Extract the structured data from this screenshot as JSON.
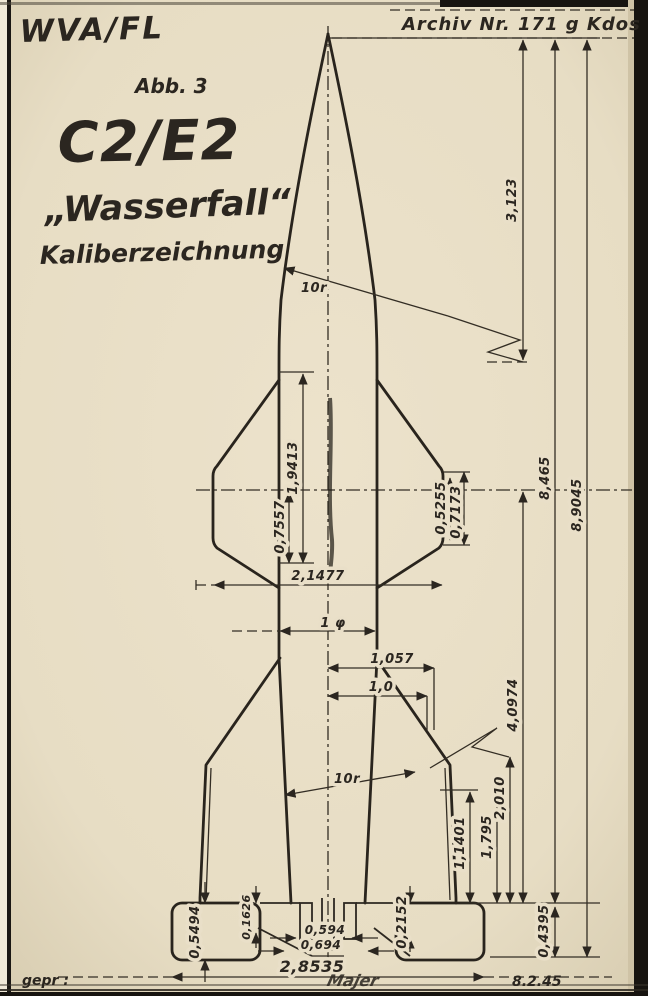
{
  "colors": {
    "paper": "#e8dec6",
    "ink": "#2b2620",
    "frame": "#16130e"
  },
  "header": {
    "org": "WVA/FL",
    "figure_no": "Abb. 3",
    "type_designation": "C2/E2",
    "project_name": "„Wasserfall“",
    "drawing_title": "Kaliberzeichnung",
    "archive_no": "Archiv Nr. 171 g Kdos"
  },
  "dims": {
    "d3123": "3,123",
    "d8465": "8,465",
    "d89045": "8,9045",
    "d19413": "1,9413",
    "d07557": "0,7557",
    "d21477": "2,1477",
    "d05255": "0,5255",
    "d07173": "0,7173",
    "d1phi": "1 φ",
    "d1057": "1,057",
    "d10": "1,0",
    "d40974": "4,0974",
    "d2010": "2,010",
    "d1795": "1,795",
    "d11401": "1,1401",
    "d05494": "0,5494",
    "d01626": "0,1626",
    "d0594": "0,594",
    "d0694": "0,694",
    "d02152": "0,2152",
    "d04395": "0,4395",
    "d28535": "2,8535",
    "nose_radius": "10r",
    "tail_radius": "10r"
  },
  "footer": {
    "approved_label": "gepr :",
    "date": "8.2.45",
    "signature": "Majer"
  }
}
